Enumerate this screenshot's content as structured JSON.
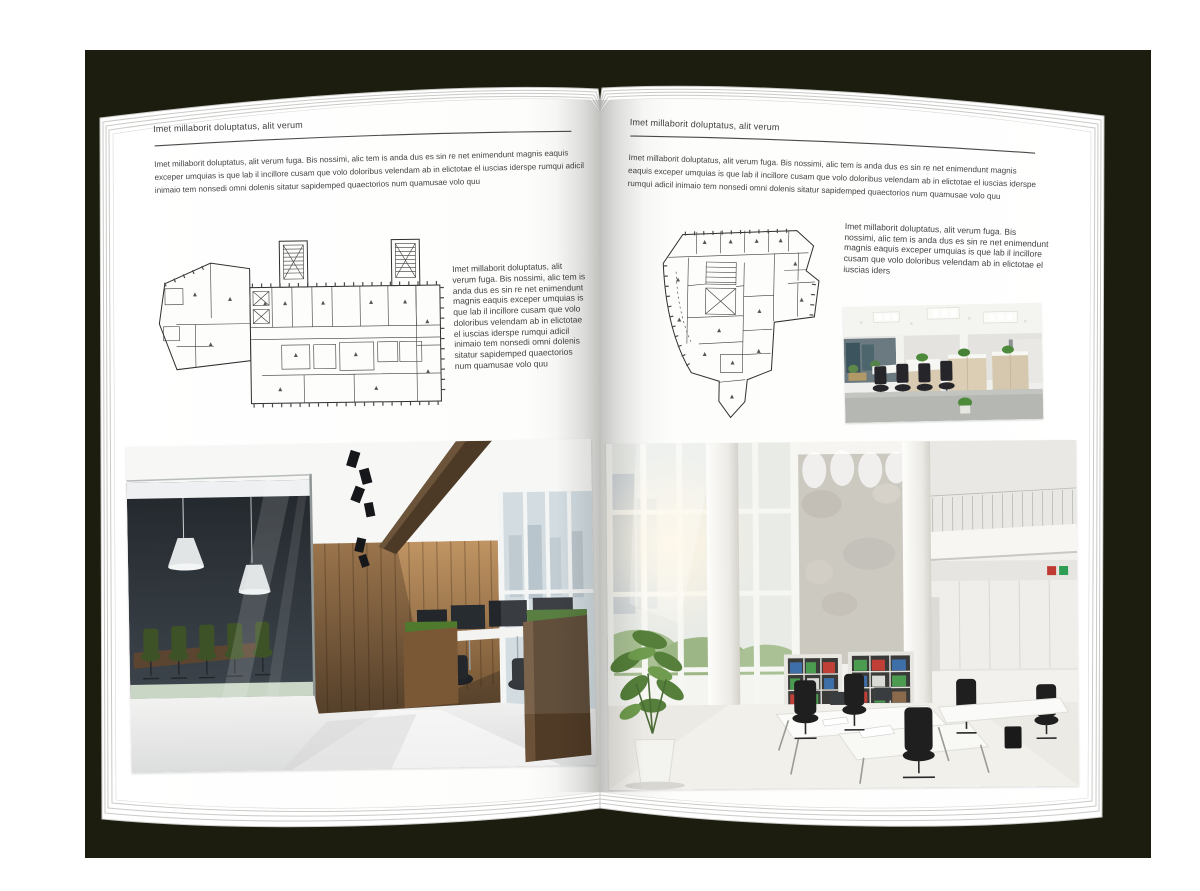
{
  "palette": {
    "backdrop": "#1c1d0f",
    "paper": "#ffffff",
    "text": "#404040",
    "rule": "#4a4a4a"
  },
  "left_page": {
    "header": "Imet millaborit doluptatus, alit verum",
    "body": "Imet millaborit doluptatus, alit verum fuga. Bis nossimi, alic tem is anda dus es sin re net enimendunt magnis eaquis exceper umquias is que lab il incillore cusam que volo doloribus velendam ab in elictotae el iuscias iderspe rumqui adicil inimaio tem nonsedi omni dolenis sitatur sapidemped quaectorios num quamusae volo quu",
    "side_text": "Imet millaborit doluptatus, alit verum fuga. Bis nossimi, alic tem is anda dus es sin re net enimendunt magnis eaquis exceper umquias is que lab il incillore cusam que volo doloribus velendam ab in elictotae el iuscias iderspe rumqui adicil inimaio tem nonsedi omni dolenis sitatur sapidemped quaectorios num quamusae volo quu"
  },
  "right_page": {
    "header": "Imet millaborit doluptatus, alit verum",
    "body": "Imet millaborit doluptatus, alit verum fuga. Bis nossimi, alic tem is anda dus es sin re net enimendunt magnis eaquis exceper umquias is que lab il incillore cusam que volo doloribus velendam ab in elictotae el iuscias iderspe rumqui adicil inimaio tem nonsedi omni dolenis sitatur sapidemped quaectorios num quamusae volo quu",
    "side_text": "Imet millaborit doluptatus, alit verum fuga. Bis nossimi, alic tem is anda dus es sin re net enimendunt magnis eaquis exceper umquias is que lab il incillore cusam que volo doloribus velendam ab in elictotae el iuscias iders"
  },
  "images": {
    "left_floor_plan": "architectural floor plan, level drawing",
    "right_floor_plan": "architectural floor plan, irregular tower level",
    "left_photo": "loft office interior with glass meeting room and wooden wall",
    "right_photo": "double-height white open office with binder shelves",
    "right_small_photo": "open plan office with workstation rows"
  }
}
